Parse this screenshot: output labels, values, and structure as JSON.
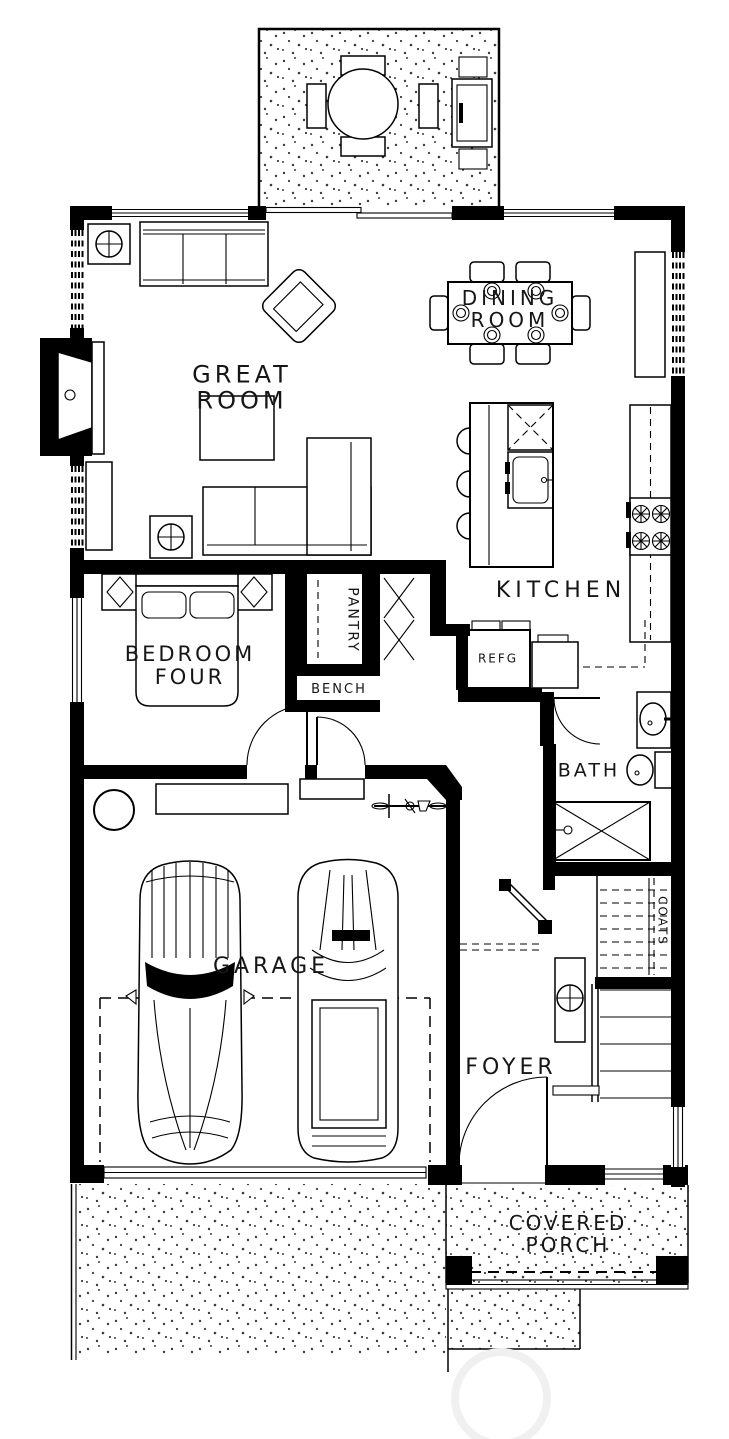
{
  "rooms": {
    "great_room": {
      "line1": "GREAT",
      "line2": "ROOM"
    },
    "dining_room": {
      "line1": "DINING",
      "line2": "ROOM"
    },
    "kitchen": {
      "label": "KITCHEN"
    },
    "bedroom_four": {
      "line1": "BEDROOM",
      "line2": "FOUR"
    },
    "pantry": {
      "label": "PANTRY"
    },
    "bench": {
      "label": "BENCH"
    },
    "refrigerator": {
      "label": "REFG"
    },
    "bath": {
      "label": "BATH"
    },
    "garage": {
      "label": "GARAGE"
    },
    "foyer": {
      "label": "FOYER"
    },
    "coats_closet": {
      "label": "COATS"
    },
    "covered_porch": {
      "line1": "COVERED",
      "line2": "PORCH"
    }
  },
  "colors": {
    "ink": "#000000",
    "paper": "#ffffff",
    "stipple": "#3c3c3c",
    "watermark": "#f0f0f0"
  }
}
